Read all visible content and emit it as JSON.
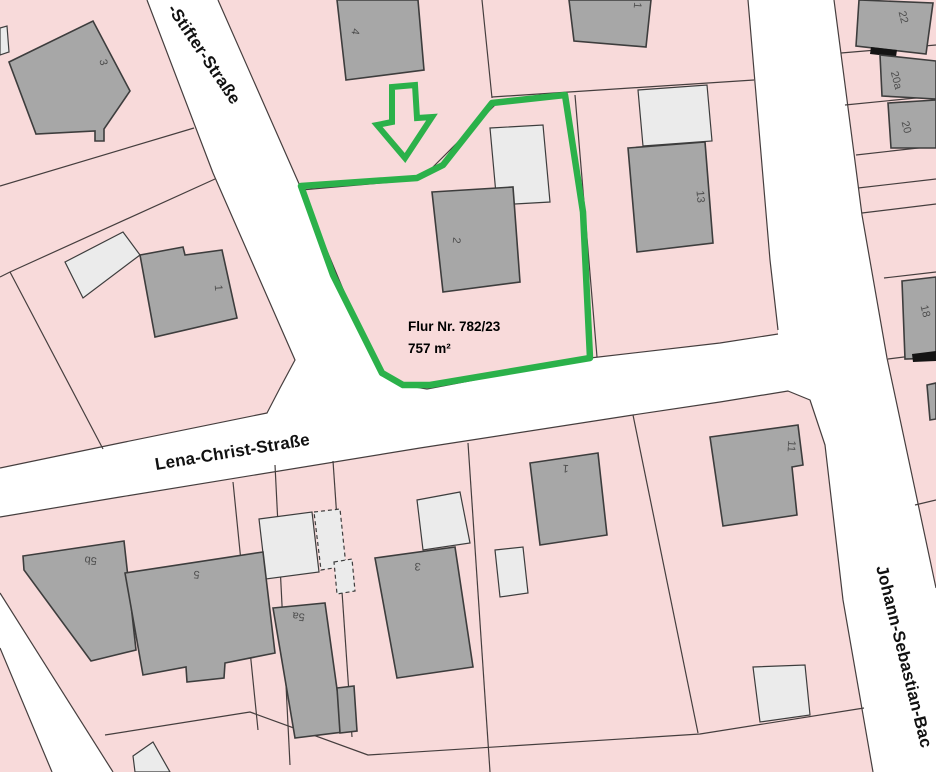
{
  "map": {
    "streets": [
      {
        "name": "-Stifter-Straße"
      },
      {
        "name": "Lena-Christ-Straße"
      },
      {
        "name": "Johann-Sebastian-Bac"
      }
    ],
    "highlight": {
      "title": "Flur Nr. 782/23",
      "area": "757 m²"
    },
    "house_numbers": [
      {
        "text": "3"
      },
      {
        "text": "4"
      },
      {
        "text": "1"
      },
      {
        "text": "13"
      },
      {
        "text": "22"
      },
      {
        "text": "20a"
      },
      {
        "text": "20"
      },
      {
        "text": "18"
      },
      {
        "text": "2"
      },
      {
        "text": "1"
      },
      {
        "text": "5b"
      },
      {
        "text": "5"
      },
      {
        "text": "5a"
      },
      {
        "text": "3"
      },
      {
        "text": "1"
      },
      {
        "text": "11"
      }
    ],
    "colors": {
      "parcel": "#f8dada",
      "street": "#ffffff",
      "building": "#a7a7a7",
      "outbuilding": "#ebebeb",
      "boundary": "#453e3e",
      "highlight": "#2bb14a",
      "numcolor": "#4d4d4d",
      "labelcolor": "#111111"
    }
  }
}
